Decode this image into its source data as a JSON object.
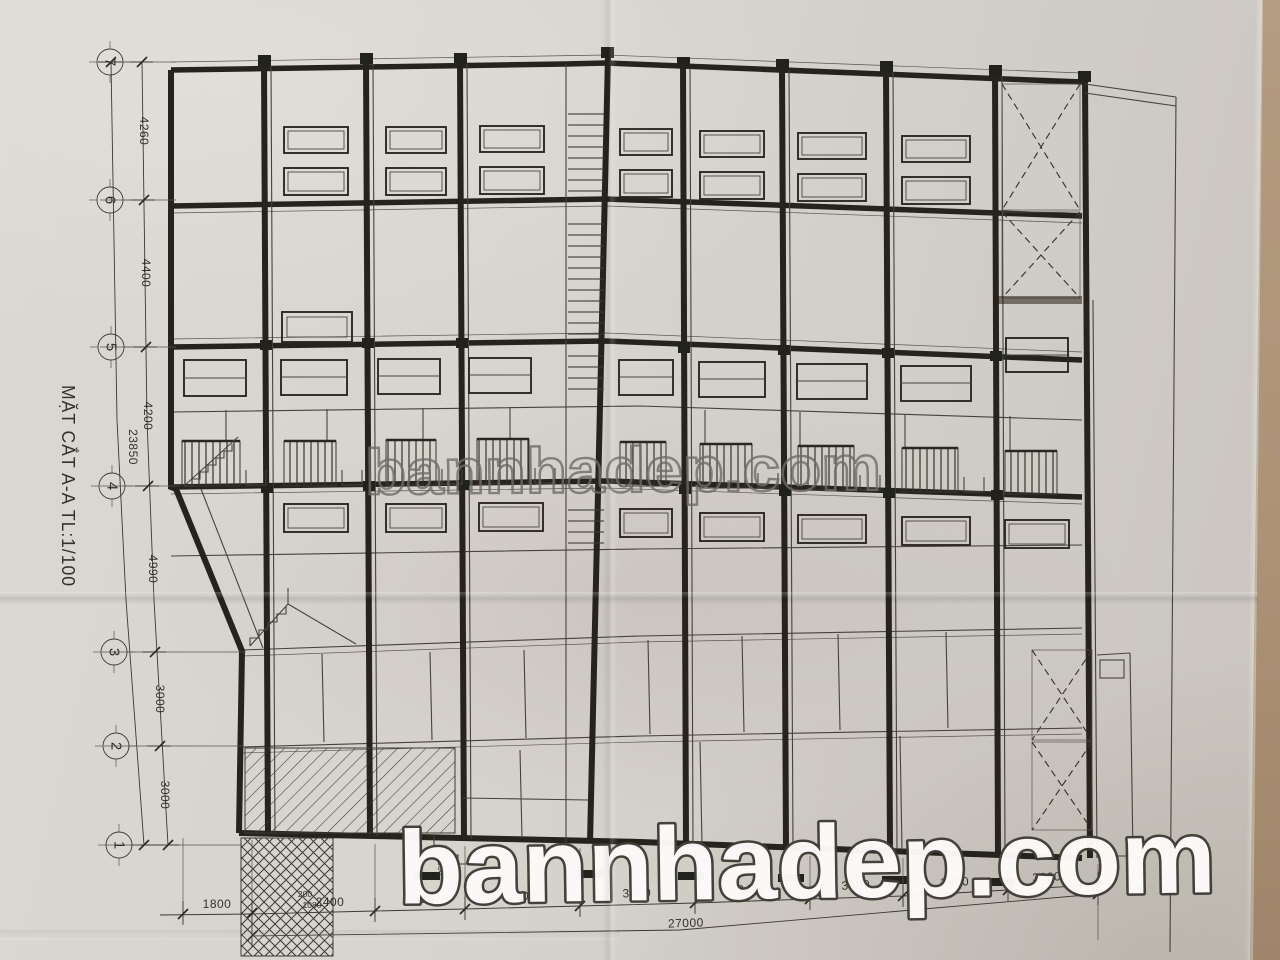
{
  "title": "MẶT CẮT A-A TL:1/100",
  "grid_bubbles": [
    "7",
    "6",
    "5",
    "4",
    "3",
    "2",
    "1"
  ],
  "vertical_dims": {
    "segments": [
      "4260",
      "4400",
      "4200",
      "4990",
      "3000",
      "3000"
    ],
    "overall": "23850"
  },
  "horizontal_dims": {
    "segments": [
      "1800",
      "2400",
      "2800",
      "3400",
      "3400",
      "3400",
      "3400",
      "3400",
      "3000"
    ],
    "overall": "27000",
    "minor": [
      "200",
      "1080",
      "1200"
    ]
  },
  "watermark": {
    "center": "bannhadep.com",
    "bottom": "bannhadep.com"
  },
  "colors": {
    "paper": "#d6d2cc",
    "ink": "#26221c",
    "table": "#ad9376",
    "watermark_fill": "#fcfbf9"
  }
}
